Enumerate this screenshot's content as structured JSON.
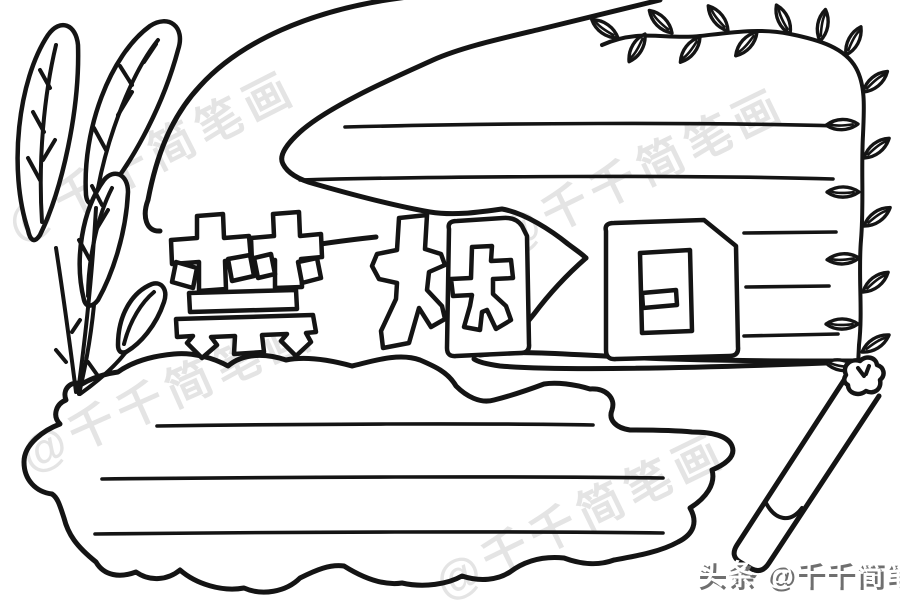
{
  "canvas": {
    "width": 900,
    "height": 600,
    "background_color": "#ffffff",
    "ink_color": "#141414"
  },
  "title": {
    "text": "禁烟日",
    "characters": [
      "禁",
      "烟",
      "日"
    ],
    "style": "hollow bubble outline letters"
  },
  "watermark": {
    "text": "@千千简笔画",
    "color": "#e4e4e4",
    "count": 4
  },
  "attribution": {
    "text": "头条 @千千简笔画",
    "color": "#ffffff",
    "shadow_color": "#6f6f6f"
  },
  "scene": {
    "elements": [
      "left-leaves",
      "speech-bubble",
      "vine-border",
      "cloud-text-box",
      "cigarette"
    ],
    "speech_bubble_long_lines": 2,
    "speech_bubble_short_lines": 3,
    "cloud_lines": 3
  }
}
